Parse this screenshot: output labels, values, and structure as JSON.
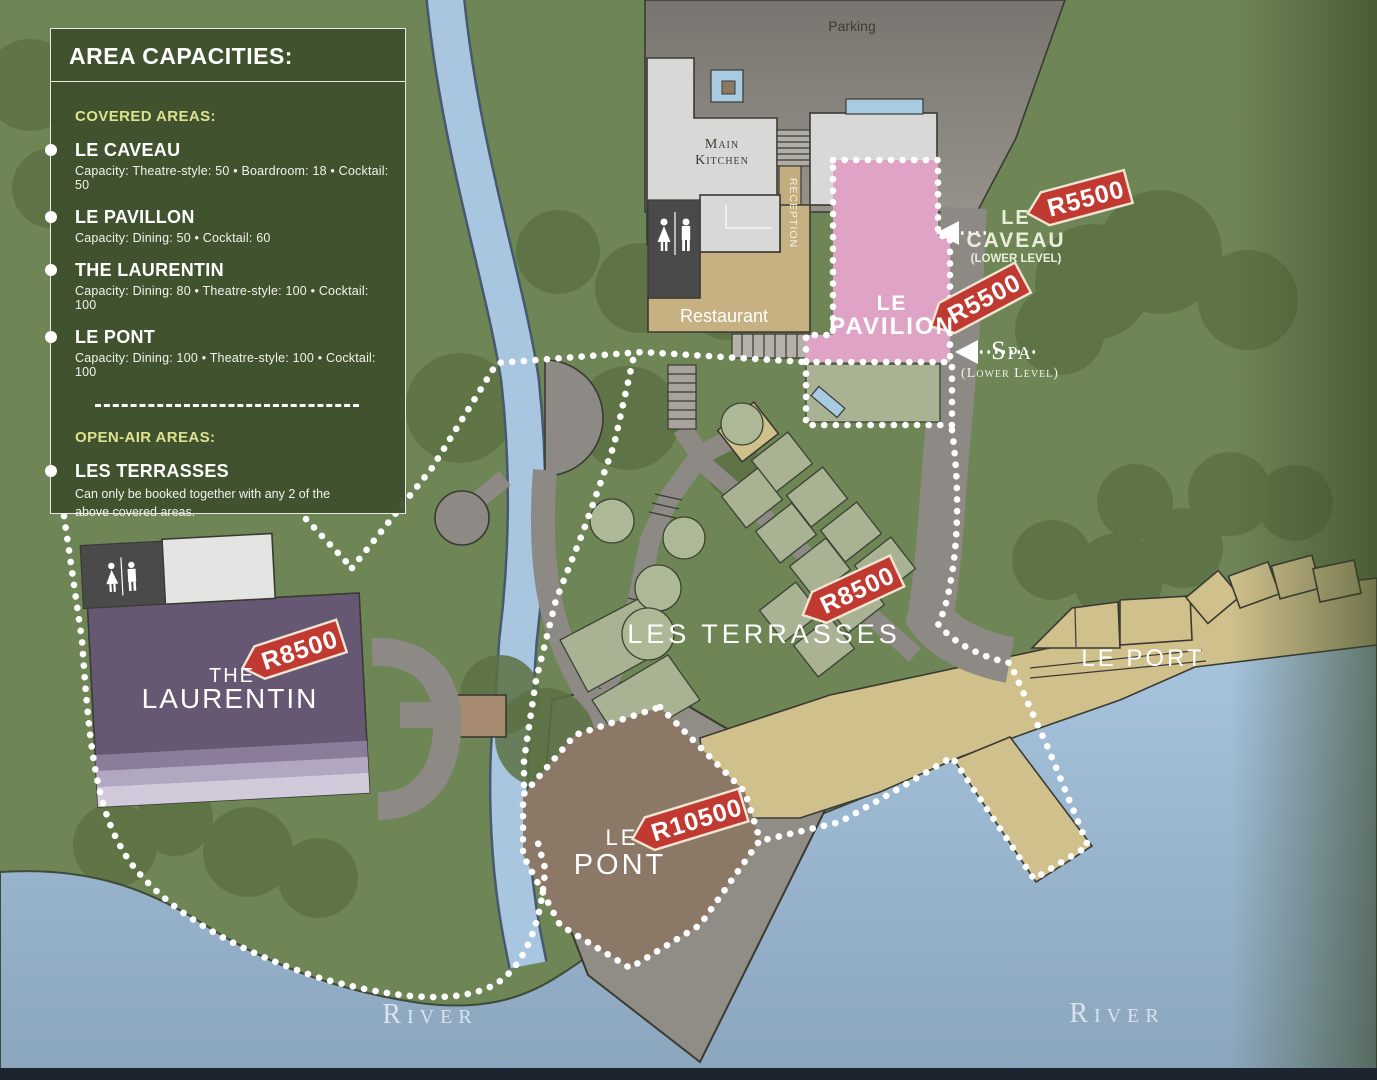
{
  "legend": {
    "title": "AREA CAPACITIES:",
    "covered_heading": "COVERED AREAS:",
    "items": [
      {
        "name": "LE CAVEAU",
        "capacity": "Capacity:  Theatre-style: 50 • Boardroom: 18 • Cocktail: 50"
      },
      {
        "name": "LE PAVILLON",
        "capacity": "Capacity:  Dining: 50 • Cocktail: 60"
      },
      {
        "name": "THE LAURENTIN",
        "capacity": "Capacity:  Dining: 80 • Theatre-style: 100  • Cocktail: 100"
      },
      {
        "name": "LE PONT",
        "capacity": "Capacity:  Dining: 100 • Theatre-style: 100 • Cocktail: 100"
      }
    ],
    "open_air_heading": "OPEN-AIR AREAS:",
    "open_air_item": {
      "name": "LES TERRASSES",
      "note_line1": "Can only be booked together with any 2 of the",
      "note_line2": "above covered areas."
    }
  },
  "map": {
    "parking_label": "Parking",
    "kitchen_line1": "Main",
    "kitchen_line2": "Kitchen",
    "reception_label": "RECEPTION",
    "restaurant_label": "Restaurant",
    "pavilion": {
      "line1": "LE",
      "line2": "PAVILION"
    },
    "caveau": {
      "line1": "LE",
      "line2": "CAVEAU",
      "sub": "(LOWER LEVEL)"
    },
    "spa": {
      "name": "Spa",
      "sub": "(Lower Level)"
    },
    "terrasses": {
      "label": "LES TERRASSES"
    },
    "laurentin": {
      "line1": "THE",
      "line2": "LAURENTIN"
    },
    "pont": {
      "line1": "LE",
      "line2": "PONT"
    },
    "port": {
      "label": "LE PORT"
    },
    "river_label_left": "River",
    "river_label_right": "River"
  },
  "price_tags": {
    "caveau": "R5500",
    "pavilion": "R5500",
    "terrasses": "R8500",
    "laurentin": "R8500",
    "pont": "R10500"
  },
  "colors": {
    "background_green": "#6e8556",
    "tree_green": "#5c7143",
    "water_blue": "#a7c4de",
    "pavilion_pink": "#dfa3c6",
    "laurentin_purple": "#665873",
    "pont_brown": "#8b7866",
    "port_tan": "#cfc08c",
    "price_tag_red": "#c13a31",
    "legend_green": "#3e4f2d",
    "heading_yellow": "#dde28f"
  }
}
